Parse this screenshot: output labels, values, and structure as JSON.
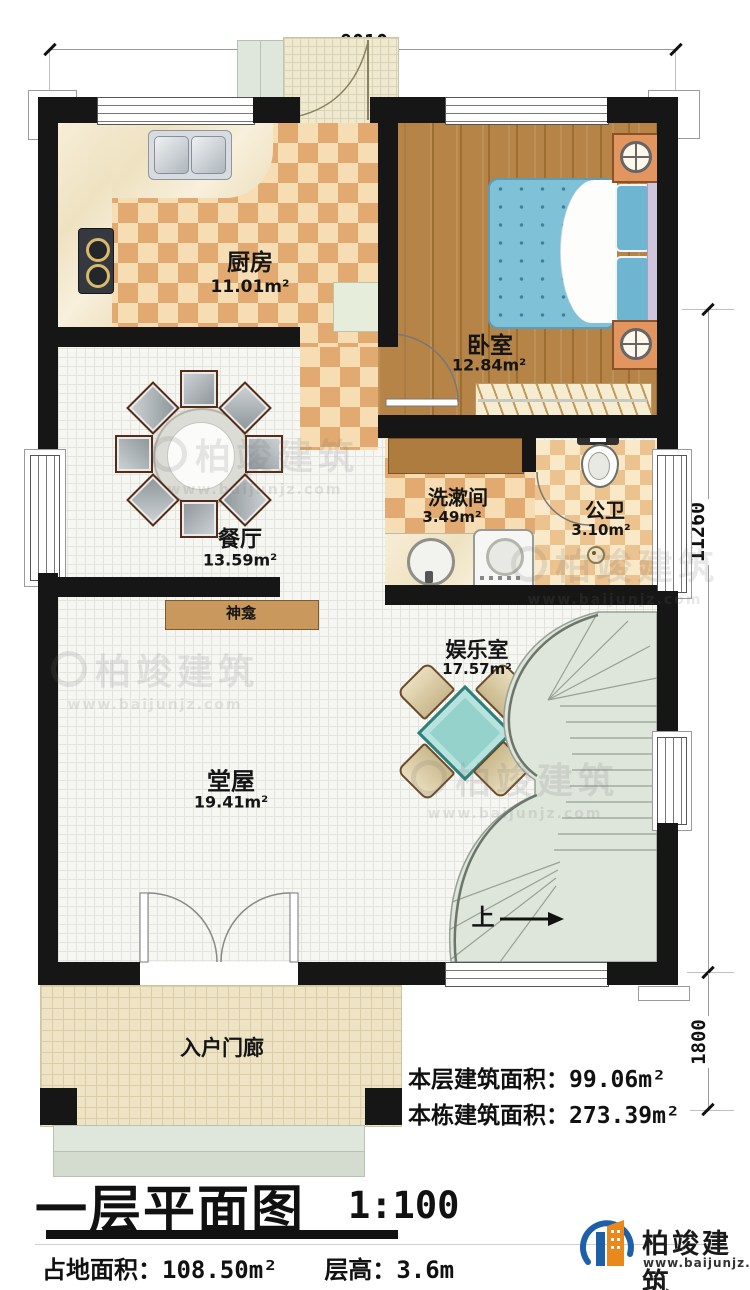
{
  "dim": {
    "top": "8010",
    "right_main": "11260",
    "right_porch": "1800"
  },
  "rooms": {
    "kitchen": {
      "name": "厨房",
      "area": "11.01m²"
    },
    "bedroom": {
      "name": "卧室",
      "area": "12.84m²"
    },
    "washroom": {
      "name": "洗漱间",
      "area": "3.49m²"
    },
    "bathroom": {
      "name": "公卫",
      "area": "3.10m²"
    },
    "dining": {
      "name": "餐厅",
      "area": "13.59m²"
    },
    "shrine": {
      "name": "神龛"
    },
    "entertainment": {
      "name": "娱乐室",
      "area": "17.57m²"
    },
    "hall": {
      "name": "堂屋",
      "area": "19.41m²"
    },
    "porch": {
      "name": "入户门廊"
    }
  },
  "stairs": {
    "up_label": "上"
  },
  "summary": {
    "floor_label": "本层建筑面积：",
    "floor_value": "99.06m²",
    "building_label": "本栋建筑面积：",
    "building_value": "273.39m²"
  },
  "title_block": {
    "title": "一层平面图",
    "scale": "1:100",
    "land_label": "占地面积：",
    "land_value": "108.50m²",
    "height_label": "层高：",
    "height_value": "3.6m"
  },
  "branding": {
    "company": "柏竣建筑",
    "website": "www.baijunjz.com"
  },
  "watermark": {
    "text": "柏竣建筑",
    "url": "www.baijunjz.com"
  },
  "colors": {
    "wall": "#161616",
    "accent_blue": "#1d5fa8",
    "accent_orange": "#e9881c",
    "bed": "#7fc2d8",
    "stair": "#dee5db",
    "mahjong_table": "#96d2cc"
  }
}
